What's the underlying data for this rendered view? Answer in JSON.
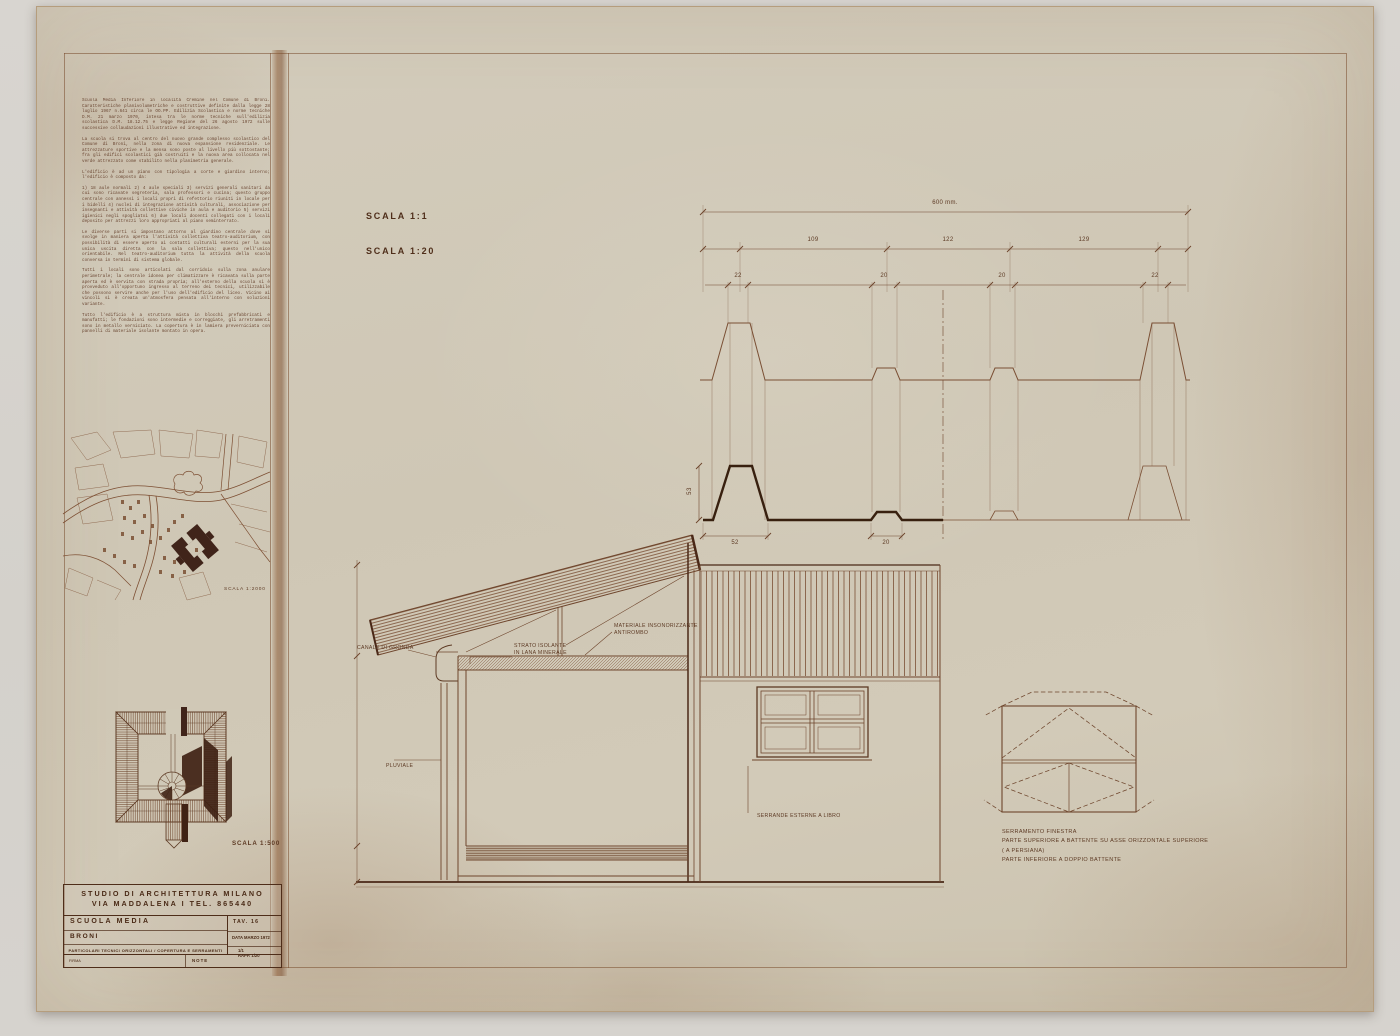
{
  "scales": {
    "profile": "SCALA 1:1",
    "section": "SCALA 1:20",
    "site_plan": "SCALA 1:2000",
    "axonometric": "SCALA 1:500"
  },
  "dims": {
    "total": "600 mm.",
    "seg": [
      "109",
      "122",
      "129"
    ],
    "ribs": [
      "22",
      "20",
      "20",
      "22"
    ],
    "bottom": [
      "52",
      "20"
    ],
    "height": "53"
  },
  "labels": {
    "gutter": "CANALE DI GRONDA",
    "insulation_1": "STRATO ISOLANTE",
    "insulation_2": "IN LANA MINERALE",
    "soundproof_1": "MATERIALE INSONORIZZANTE",
    "soundproof_2": "ANTIROMBO",
    "downpipe": "PLUVIALE",
    "shutters": "SERRANDE ESTERNE A LIBRO"
  },
  "window_note": {
    "lines": [
      "SERRAMENTO FINESTRA",
      "PARTE SUPERIORE   A BATTENTE   SU ASSE   ORIZZONTALE SUPERIORE",
      "( A PERSIANA)",
      "PARTE INFERIORE    A DOPPIO   BATTENTE"
    ]
  },
  "sidebar": {
    "paragraphs": [
      "Scuola Media Inferiore in località Cremine nel Comune di Broni. Caratteristiche planivolumetriche e costruttive definite dalla legge 28 luglio 1967 n.641 circa le OO.PP. Edilizia Scolastica e norme tecniche D.M. 21 marzo 1970, intesa tra le norme tecniche sull'edilizia scolastica D.M. 18.12.75 e legge Regione del 26 agosto 1972 sulle successive collaudazioni illustrative ed integrazione.",
      "La scuola si trova al centro del nuovo grande complesso scolastico del Comune di Broni, nella zona di nuova espansione residenziale. Le attrezzature sportive e la mensa sono poste al livello più sottostante; fra gli edifici scolastici già costruiti e la nuova area collocata nel verde attrezzato come stabilito nella planimetria generale.",
      "L'edificio è ad un piano con tipologia a corte e giardino interno; l'edificio è composto da:",
      "1) 18 aule normali 2) 4 aule speciali 3) servizi generali sanitari da cui sono ricavate segreteria, sala professori e cucina; questo gruppo centrale con annessi i locali propri di refettorio riuniti in locale per i bidelli 4) nuclei di integrazione attività culturali, associazione per insegnanti e attività collettive civiche in aula e auditorio 5) servizi igienici negli spogliatoi 6) due locali docenti collegati con i locali deposito per attrezzi loro appropriati al piano seminterrato.",
      "Le diverse parti si impostano attorno al giardino centrale dove si svolge in maniera aperta l'attività collettiva teatro-auditorium, con possibilità di essere aperto ai contatti culturali esterni per la sua unica uscita diretta con la sala collettiva; questo nell'unico orientabile. Nel teatro-auditorium tutta la attività della scuola conversa in termini di sistema globale.",
      "Tutti i locali sono articolati dal corridoio sulla zona anulare perimetrale; la centrale idonea per climatizzare è ricavata sulla parte aperta ed è servita con strada propria; all'esterno della scuola si è provveduto all'opportuno ingresso al terreno dei tecnici, utilizzabile che possono servire anche per l'uso dell'edificio del liceo. Vicino ai vincoli si è creata un'atmosfera pensata all'interno con soluzioni variante.",
      "Tutto l'edificio è a struttura mista in blocchi prefabbricati e manufatti; le fondazioni sono intermedie e correggiate, gli arretramenti sono in metallo verniciato. La copertura è in lamiera preverniciata con pannelli di materiale isolante montato in opera."
    ]
  },
  "title_block": {
    "studio_line1": "STUDIO  DI  ARCHITETTURA  MILANO",
    "studio_line2": "VIA  MADDALENA  I      TEL. 865440",
    "project": "SCUOLA   MEDIA",
    "location": "BRONI",
    "drawing_title": "PARTICOLARI TECNICI ORIZZONTALI / COPERTURA E SERRAMENTI",
    "tav": "TAV.  16",
    "date": "DATA MARZO 1972",
    "ratio_line1": "1/1",
    "ratio_line2": "RAPP.  1/20",
    "firma": "FIRMA",
    "note": "NOTE"
  }
}
